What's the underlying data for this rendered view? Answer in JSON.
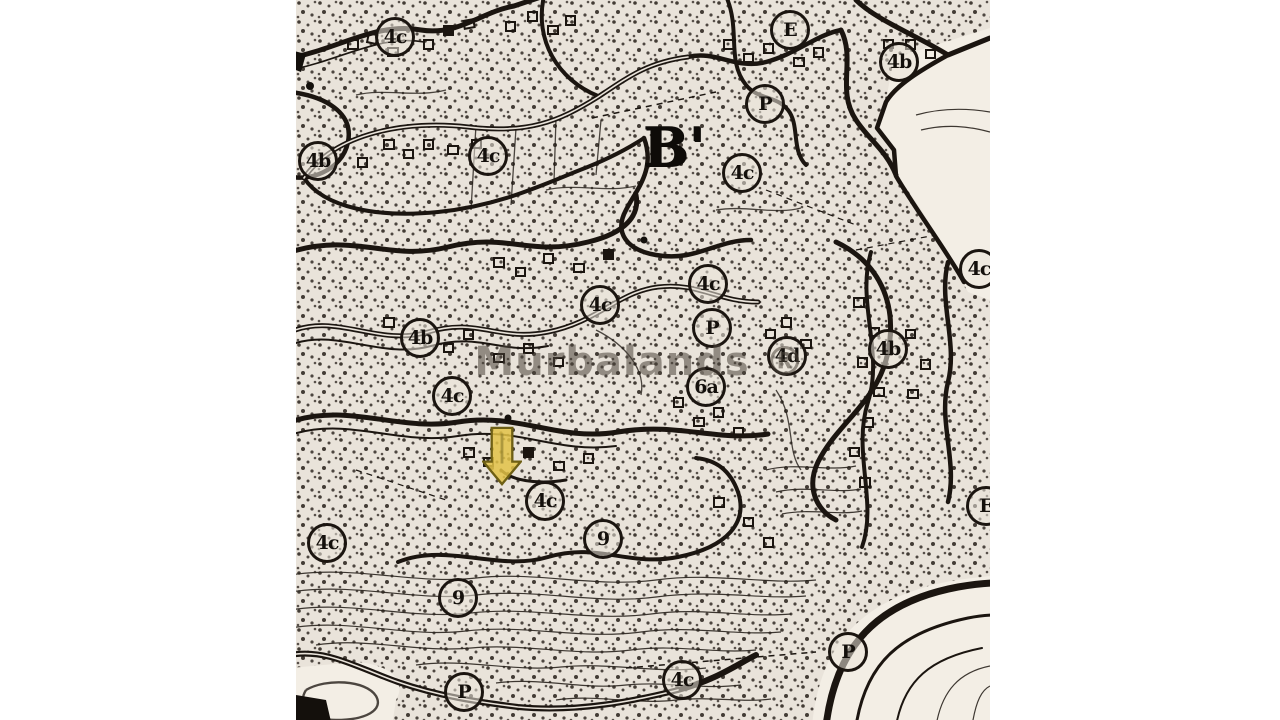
{
  "page": {
    "background_color": "#ffffff",
    "description_text": ""
  },
  "map": {
    "x": 296,
    "y": 0,
    "width": 694,
    "height": 720,
    "paper_color": "#e9e3da",
    "light_region_color": "#f3eee5",
    "ink_color": "#1b1510",
    "watermark": {
      "text": "Murbalands ®",
      "cx": 344,
      "cy": 362,
      "color_rgba": "rgba(75,67,58,0.55)"
    },
    "section_label": {
      "text": "B'",
      "cx": 378,
      "cy": 147
    },
    "marker_arrow": {
      "shape": "down-arrow",
      "cx": 206,
      "cy": 455,
      "fill": "#e2c246",
      "outline": "#6e5f14"
    },
    "zone_labels": [
      {
        "text": "4c",
        "x": 99,
        "y": 37
      },
      {
        "text": "4c",
        "x": 192,
        "y": 156
      },
      {
        "text": "4b",
        "x": 22,
        "y": 161
      },
      {
        "text": "E",
        "x": 494,
        "y": 30
      },
      {
        "text": "4b",
        "x": 603,
        "y": 62
      },
      {
        "text": "P",
        "x": 469,
        "y": 104
      },
      {
        "text": "4c",
        "x": 446,
        "y": 173
      },
      {
        "text": "4c",
        "x": 304,
        "y": 305
      },
      {
        "text": "4c",
        "x": 412,
        "y": 284
      },
      {
        "text": "4b",
        "x": 124,
        "y": 338
      },
      {
        "text": "4c",
        "x": 156,
        "y": 396
      },
      {
        "text": "P",
        "x": 416,
        "y": 328
      },
      {
        "text": "4d",
        "x": 491,
        "y": 356
      },
      {
        "text": "6a",
        "x": 410,
        "y": 387
      },
      {
        "text": "4b",
        "x": 592,
        "y": 349
      },
      {
        "text": "4c",
        "x": 683,
        "y": 269
      },
      {
        "text": "4c",
        "x": 31,
        "y": 543
      },
      {
        "text": "4c",
        "x": 249,
        "y": 501
      },
      {
        "text": "9",
        "x": 307,
        "y": 539
      },
      {
        "text": "9",
        "x": 162,
        "y": 598
      },
      {
        "text": "P",
        "x": 168,
        "y": 692
      },
      {
        "text": "P",
        "x": 552,
        "y": 652
      },
      {
        "text": "E",
        "x": 690,
        "y": 506
      },
      {
        "text": "4c",
        "x": 386,
        "y": 680
      }
    ]
  }
}
